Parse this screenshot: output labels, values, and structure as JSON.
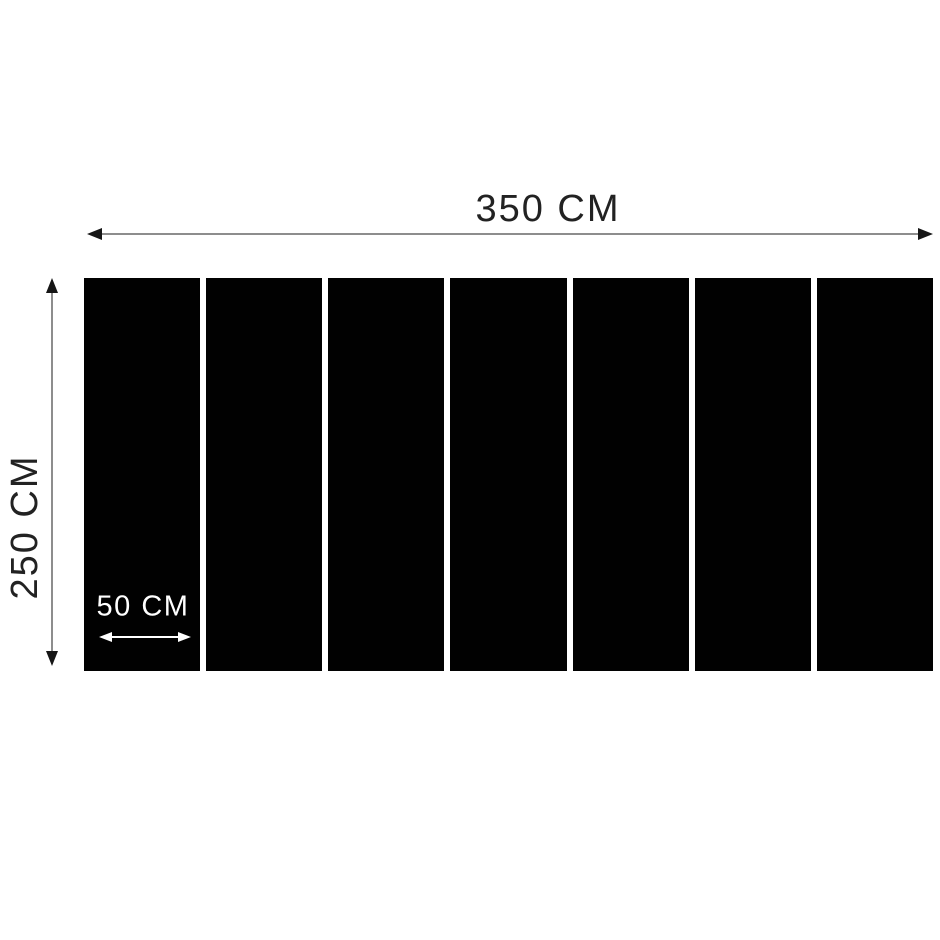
{
  "dimensions": {
    "total_width": {
      "label": "350 CM"
    },
    "total_height": {
      "label": "250 CM"
    },
    "panel_width": {
      "label": "50 CM"
    }
  },
  "panels": {
    "count": 7
  },
  "colors": {
    "background": "#ffffff",
    "panel": "#010101",
    "dimension_line": "#8d8d8d",
    "arrowhead": "#161616",
    "label_text": "#222222",
    "panel_label_text": "#ffffff"
  }
}
